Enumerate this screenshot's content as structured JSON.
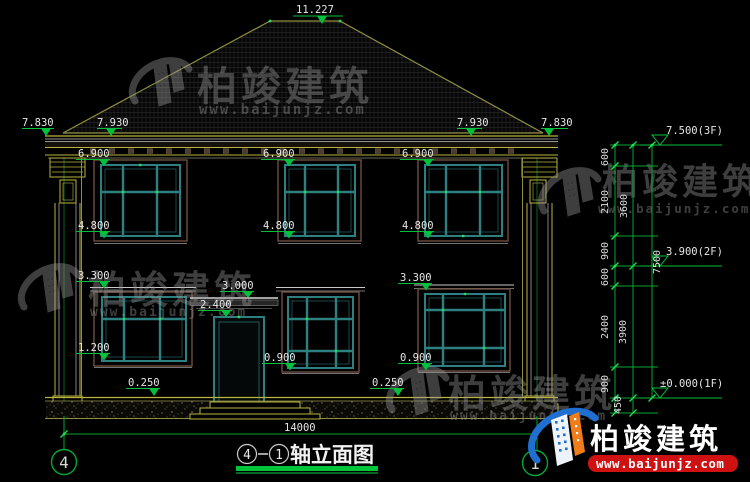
{
  "drawing_title": {
    "axis_from": "4",
    "axis_to": "1",
    "name": "轴立面图"
  },
  "axis_bubbles": {
    "left": "4",
    "right": "1"
  },
  "elevation_marks": {
    "roof_peak": "11.227",
    "eave_left_outer": "7.830",
    "eave_left_inner": "7.930",
    "eave_right_inner": "7.930",
    "eave_right_outer": "7.830",
    "level_3f": "7.500(3F)",
    "level_2f": "3.900(2F)",
    "level_1f": "±0.000(1F)",
    "eave_soffit": "6.900",
    "sill_2f": "4.800",
    "head_1f": "3.300",
    "canopy_top": "3.000",
    "door_head": "2.400",
    "sill_1f_left": "1.200",
    "sill_1f": "0.900",
    "plinth_top": "0.250"
  },
  "dim_chain_right": {
    "segments": [
      "600",
      "2100",
      "900",
      "600",
      "2400",
      "900",
      "450"
    ],
    "subtotals": [
      "3600",
      "3900"
    ],
    "total": "7500"
  },
  "dim_bottom": {
    "total_width": "14000"
  },
  "watermark": {
    "brand": "柏竣建筑",
    "site": "www.baijunjz.com"
  },
  "brand_logo": {
    "brand": "柏竣建筑",
    "site": "www.baijunjz.com"
  }
}
